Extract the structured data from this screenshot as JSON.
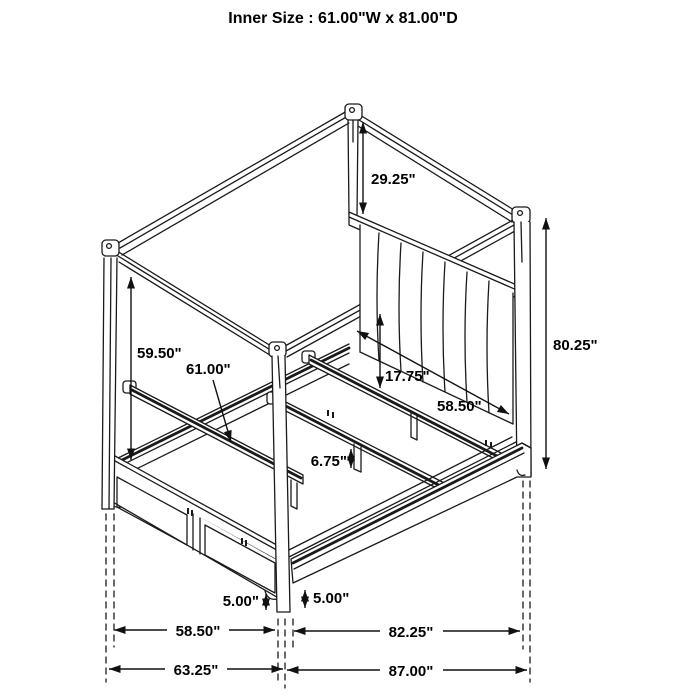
{
  "title": "Inner Size : 61.00\"W x 81.00\"D",
  "diagram": "canopy-bed-dimension-drawing",
  "colors": {
    "line": "#1a1a1a",
    "background": "#ffffff"
  },
  "dimensions": {
    "canopy_post_above_headboard": "29.25\"",
    "overall_height": "80.25\"",
    "rail_to_canopy": "59.50\"",
    "inner_width": "61.00\"",
    "deck_height": "17.75\"",
    "inner_rail_width": "58.50\"",
    "support_leg_height": "6.75\"",
    "footboard_clearance": "5.00\"",
    "siderail_clearance": "5.00\"",
    "footboard_width": "58.50\"",
    "siderail_length": "82.25\"",
    "overall_width": "63.25\"",
    "overall_depth": "87.00\""
  }
}
